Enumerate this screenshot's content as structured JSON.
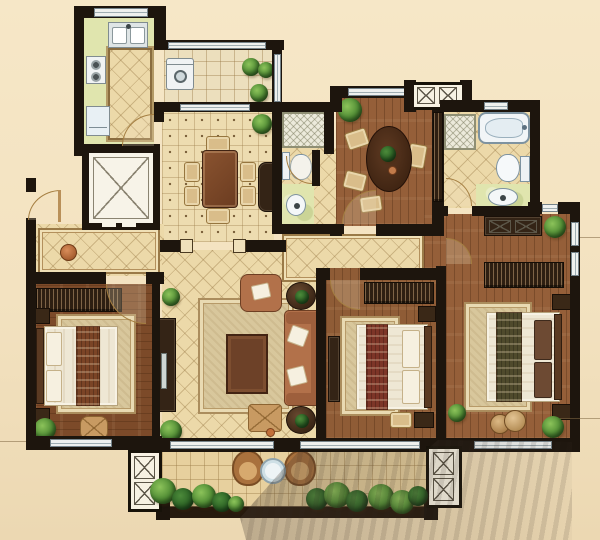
{
  "plan": {
    "name": "Apartment floor plan",
    "view": "top-down rendered color plan"
  },
  "palette": {
    "background": "#f3e2c0",
    "wall": "#1d150d",
    "tile_floor": "#ecd9a9",
    "green_floor": "#e0e5ae",
    "wood_floor": "#955f39",
    "window": "#eef0ee",
    "plant_green": "#4e8a33",
    "sofa_terracotta": "#b2714a",
    "dark_furniture": "#342416",
    "bed_linen": "#eee7d4",
    "shadow": "rgba(70,58,48,0.5)"
  },
  "rooms": {
    "kitchen": {
      "name": "Kitchen",
      "items": [
        "double-basin sink",
        "two-burner stove",
        "refrigerator",
        "prep counter"
      ]
    },
    "utility_balcony": {
      "name": "Utility balcony",
      "items": [
        "washing machine",
        "potted plants"
      ]
    },
    "dining": {
      "name": "Dining room",
      "items": [
        "dining table",
        "six chairs",
        "sideboard",
        "potted plant"
      ]
    },
    "guest_bath": {
      "name": "Guest bathroom",
      "items": [
        "shower",
        "toilet",
        "wash basin"
      ]
    },
    "study": {
      "name": "Study / tea room",
      "items": [
        "round table",
        "four chairs",
        "potted plants"
      ]
    },
    "master_bath": {
      "name": "Master bathroom",
      "items": [
        "bathtub",
        "shower",
        "toilet",
        "wash basin"
      ]
    },
    "entry": {
      "name": "Entry foyer",
      "items": [
        "tiled mat",
        "round stool"
      ]
    },
    "elevator": {
      "name": "Elevator",
      "items": []
    },
    "hall": {
      "name": "Hallway",
      "items": []
    },
    "bedroom_left": {
      "name": "Bedroom (left)",
      "items": [
        "double bed",
        "wardrobe",
        "nightstands",
        "rug",
        "pouf",
        "potted plant"
      ]
    },
    "living": {
      "name": "Living room",
      "items": [
        "sofa",
        "armchair",
        "coffee table",
        "ottoman",
        "side tables",
        "area rug",
        "TV cabinet",
        "potted plants"
      ]
    },
    "bedroom_middle": {
      "name": "Bedroom (middle)",
      "items": [
        "double bed",
        "wardrobe",
        "nightstands",
        "TV cabinet",
        "bench",
        "rug"
      ]
    },
    "bedroom_master": {
      "name": "Master bedroom",
      "items": [
        "double bed",
        "wardrobe",
        "dresser",
        "nightstands",
        "vanity stools",
        "rug",
        "potted plants"
      ]
    },
    "balcony": {
      "name": "Balcony",
      "items": [
        "wicker chairs",
        "round glass table",
        "shrubs"
      ]
    },
    "ac_platform": {
      "name": "A/C platform",
      "items": []
    }
  }
}
